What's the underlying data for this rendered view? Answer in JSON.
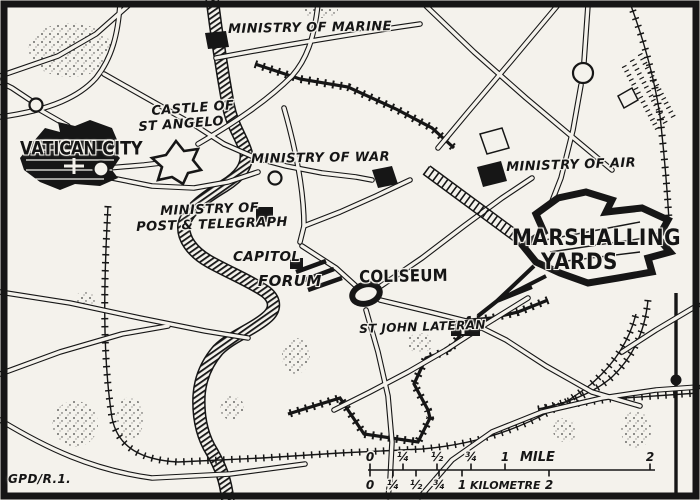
{
  "labels": {
    "ministry_of_marine": "MINISTRY OF MARINE",
    "castle_of_st_angelo_line1": "CASTLE OF",
    "castle_of_st_angelo_line2": "ST ANGELO",
    "vatican_city": "VATICAN CITY",
    "ministry_of_war": "MINISTRY OF WAR",
    "ministry_of_air": "MINISTRY OF AIR",
    "ministry_of_post_line1": "MINISTRY OF",
    "ministry_of_post_line2": "POST & TELEGRAPH",
    "capitol": "CAPITOL",
    "forum": "FORUM",
    "coliseum": "COLISEUM",
    "st_john_lateran": "ST JOHN LATERAN",
    "marshalling_yards_line1": "MARSHALLING",
    "marshalling_yards_line2": "YARDS",
    "credit": "GPD/R.1."
  },
  "scale_bar": {
    "mile": {
      "ticks": [
        "0",
        "¼",
        "½",
        "¾",
        "1",
        "2"
      ],
      "unit": "MILE"
    },
    "kilometre": {
      "ticks": [
        "0",
        "¼",
        "½",
        "¾",
        "1",
        "2"
      ],
      "unit": "KILOMETRE"
    }
  },
  "colors": {
    "ink": "#161616",
    "paper": "#f4f2ec"
  }
}
